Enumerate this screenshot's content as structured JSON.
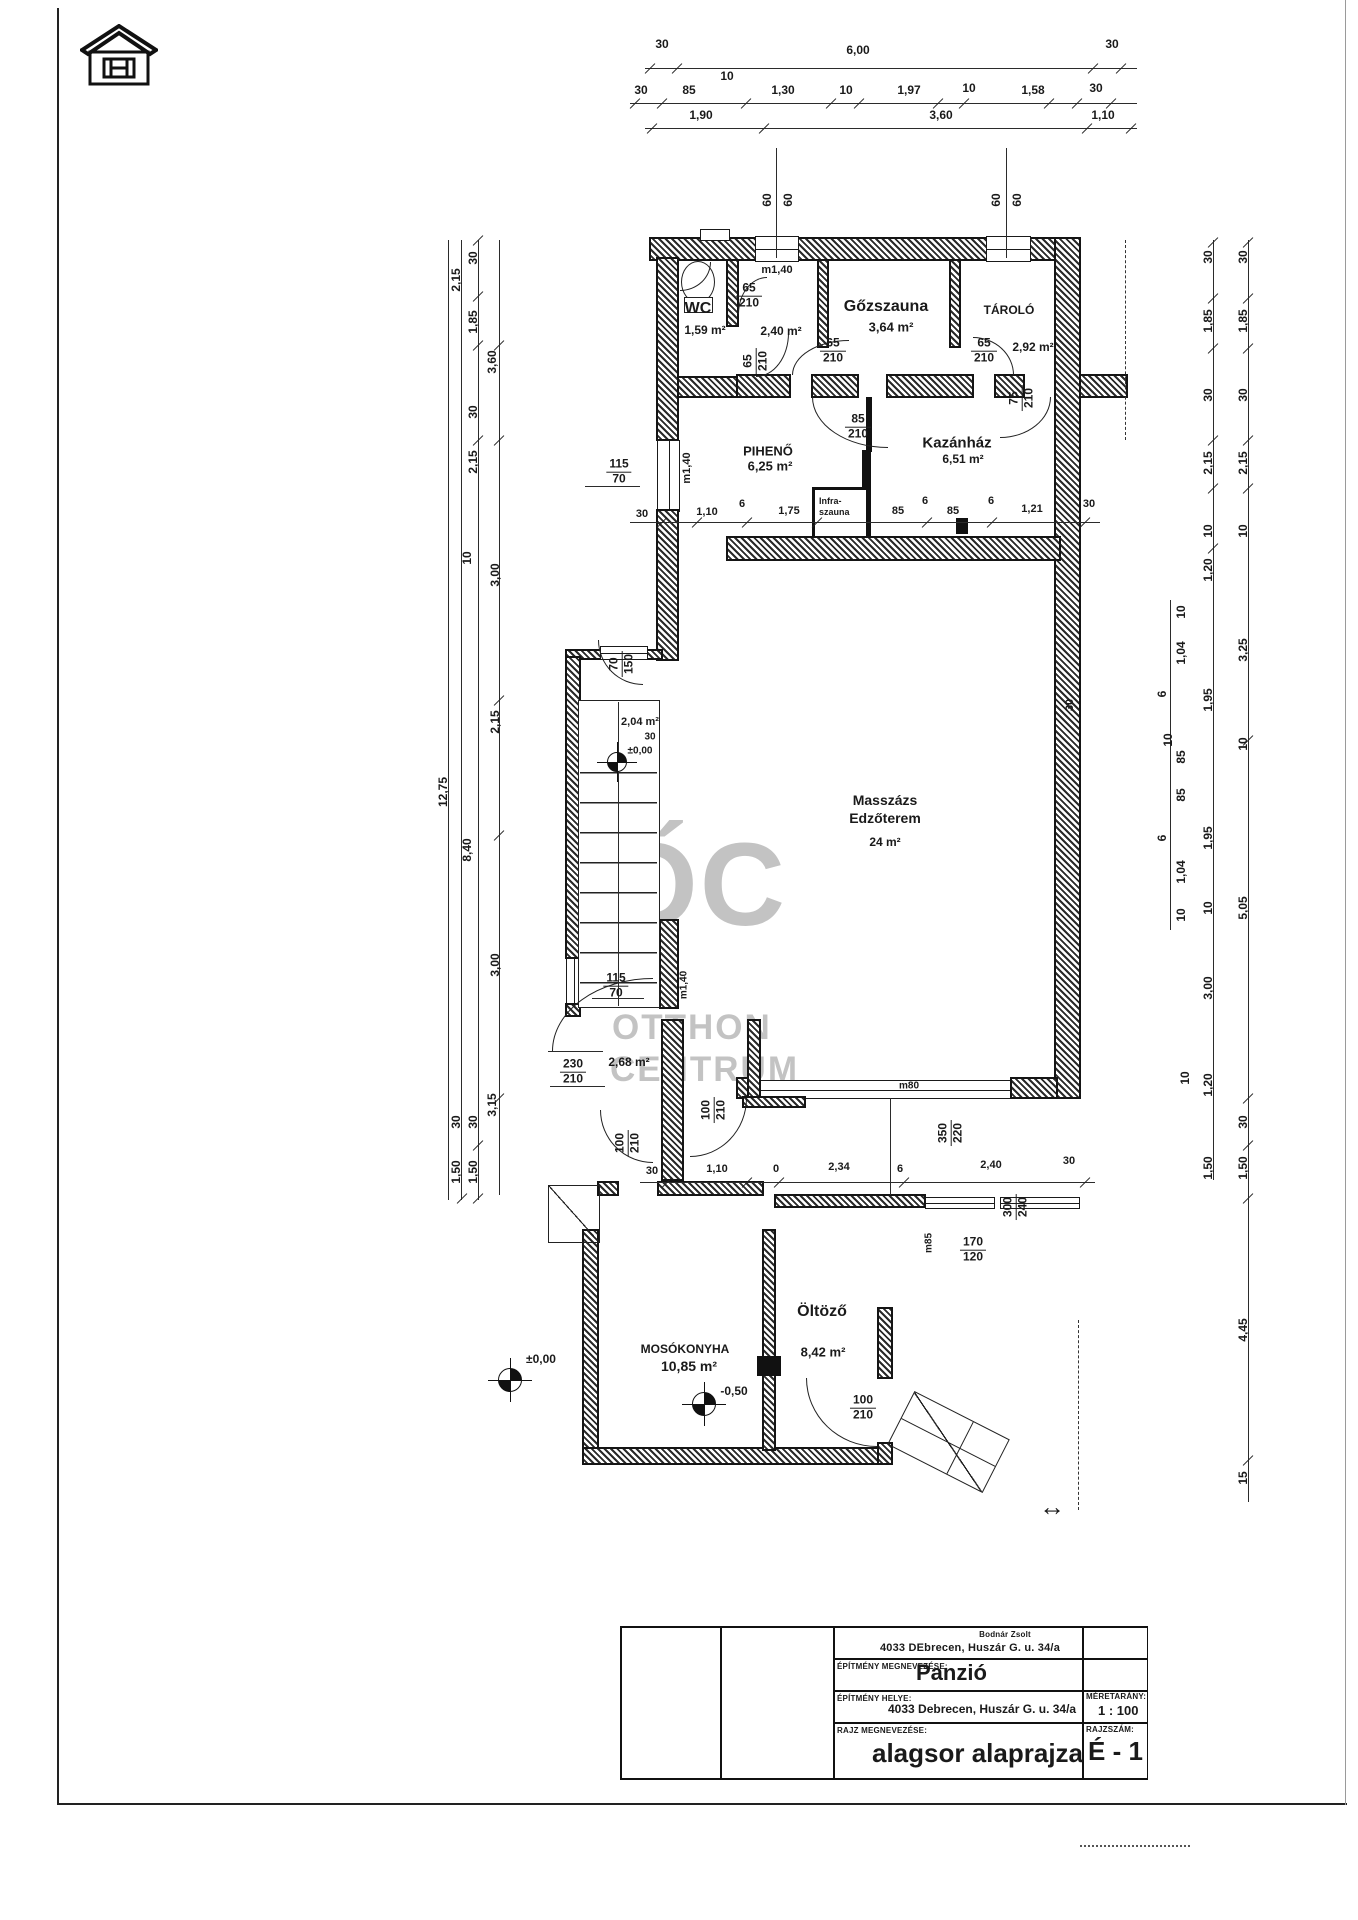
{
  "title_block": {
    "owner_name": "Bodnár Zsolt",
    "owner_address": "4033 DEbrecen, Huszár G. u. 34/a",
    "building_label": "ÉPÍTMÉNY MEGNEVEZÉSE:",
    "building_value": "Panzió",
    "site_label": "ÉPÍTMÉNY HELYE:",
    "site_value": "4033 Debrecen, Huszár G. u. 34/a",
    "scale_label": "MÉRETARÁNY:",
    "scale_value": "1 : 100",
    "drawing_label": "RAJZ MEGNEVEZÉSE:",
    "drawing_value": "alagsor alaprajza",
    "number_label": "RAJZSZÁM:",
    "number_value": "É - 1"
  },
  "watermark": {
    "monogram": "ŐC",
    "line1": "OTTHON",
    "line2": "CENTRUM"
  },
  "infra_box": {
    "line1": "Infra-",
    "line2": "szauna"
  },
  "labels": [
    {
      "t": "30",
      "x": 662,
      "y": 44
    },
    {
      "t": "6,00",
      "x": 858,
      "y": 50
    },
    {
      "t": "30",
      "x": 1112,
      "y": 44
    },
    {
      "t": "10",
      "x": 727,
      "y": 76
    },
    {
      "t": "30",
      "x": 641,
      "y": 90
    },
    {
      "t": "85",
      "x": 689,
      "y": 90
    },
    {
      "t": "1,30",
      "x": 783,
      "y": 90
    },
    {
      "t": "10",
      "x": 846,
      "y": 90
    },
    {
      "t": "1,97",
      "x": 909,
      "y": 90
    },
    {
      "t": "10",
      "x": 969,
      "y": 88
    },
    {
      "t": "1,58",
      "x": 1033,
      "y": 90
    },
    {
      "t": "30",
      "x": 1096,
      "y": 88
    },
    {
      "t": "1,90",
      "x": 701,
      "y": 115
    },
    {
      "t": "3,60",
      "x": 941,
      "y": 115
    },
    {
      "t": "1,10",
      "x": 1103,
      "y": 115
    },
    {
      "t": "60",
      "x": 767,
      "y": 200,
      "r": -90
    },
    {
      "t": "60",
      "x": 788,
      "y": 200,
      "r": -90
    },
    {
      "t": "60",
      "x": 996,
      "y": 200,
      "r": -90
    },
    {
      "t": "60",
      "x": 1017,
      "y": 200,
      "r": -90
    },
    {
      "t": "2,15",
      "x": 456,
      "y": 280,
      "r": -90
    },
    {
      "t": "30",
      "x": 473,
      "y": 258,
      "r": -90
    },
    {
      "t": "1,85",
      "x": 473,
      "y": 322,
      "r": -90
    },
    {
      "t": "3,60",
      "x": 492,
      "y": 362,
      "r": -90
    },
    {
      "t": "30",
      "x": 473,
      "y": 412,
      "r": -90
    },
    {
      "t": "2,15",
      "x": 473,
      "y": 462,
      "r": -90
    },
    {
      "t": "10",
      "x": 467,
      "y": 558,
      "r": -90
    },
    {
      "t": "3,00",
      "x": 495,
      "y": 575,
      "r": -90
    },
    {
      "t": "2,15",
      "x": 495,
      "y": 722,
      "r": -90
    },
    {
      "t": "12,75",
      "x": 443,
      "y": 792,
      "r": -90
    },
    {
      "t": "8,40",
      "x": 467,
      "y": 850,
      "r": -90
    },
    {
      "t": "3,00",
      "x": 495,
      "y": 965,
      "r": -90
    },
    {
      "t": "3,15",
      "x": 492,
      "y": 1105,
      "r": -90
    },
    {
      "t": "30",
      "x": 473,
      "y": 1122,
      "r": -90
    },
    {
      "t": "1,50",
      "x": 473,
      "y": 1172,
      "r": -90
    },
    {
      "t": "30",
      "x": 456,
      "y": 1122,
      "r": -90
    },
    {
      "t": "1,50",
      "x": 456,
      "y": 1172,
      "r": -90
    },
    {
      "t": "30",
      "x": 1208,
      "y": 257,
      "r": -90
    },
    {
      "t": "30",
      "x": 1243,
      "y": 257,
      "r": -90
    },
    {
      "t": "1,85",
      "x": 1208,
      "y": 321,
      "r": -90
    },
    {
      "t": "1,85",
      "x": 1243,
      "y": 321,
      "r": -90
    },
    {
      "t": "30",
      "x": 1208,
      "y": 395,
      "r": -90
    },
    {
      "t": "30",
      "x": 1243,
      "y": 395,
      "r": -90
    },
    {
      "t": "2,15",
      "x": 1208,
      "y": 463,
      "r": -90
    },
    {
      "t": "2,15",
      "x": 1243,
      "y": 463,
      "r": -90
    },
    {
      "t": "10",
      "x": 1208,
      "y": 531,
      "r": -90
    },
    {
      "t": "10",
      "x": 1243,
      "y": 531,
      "r": -90
    },
    {
      "t": "1,20",
      "x": 1208,
      "y": 570,
      "r": -90
    },
    {
      "t": "10",
      "x": 1181,
      "y": 612,
      "r": -90
    },
    {
      "t": "1,04",
      "x": 1181,
      "y": 653,
      "r": -90
    },
    {
      "t": "6",
      "x": 1162,
      "y": 694,
      "r": -90
    },
    {
      "t": "3,25",
      "x": 1243,
      "y": 650,
      "r": -90
    },
    {
      "t": "1,95",
      "x": 1208,
      "y": 700,
      "r": -90
    },
    {
      "t": "10",
      "x": 1168,
      "y": 740,
      "r": -90
    },
    {
      "t": "85",
      "x": 1181,
      "y": 757,
      "r": -90
    },
    {
      "t": "10",
      "x": 1243,
      "y": 744,
      "r": -90
    },
    {
      "t": "85",
      "x": 1181,
      "y": 795,
      "r": -90
    },
    {
      "t": "6",
      "x": 1162,
      "y": 838,
      "r": -90
    },
    {
      "t": "1,04",
      "x": 1181,
      "y": 872,
      "r": -90
    },
    {
      "t": "1,95",
      "x": 1208,
      "y": 838,
      "r": -90
    },
    {
      "t": "10",
      "x": 1181,
      "y": 915,
      "r": -90
    },
    {
      "t": "10",
      "x": 1208,
      "y": 908,
      "r": -90
    },
    {
      "t": "5,05",
      "x": 1243,
      "y": 908,
      "r": -90
    },
    {
      "t": "3,00",
      "x": 1208,
      "y": 988,
      "r": -90
    },
    {
      "t": "10",
      "x": 1185,
      "y": 1078,
      "r": -90
    },
    {
      "t": "1,20",
      "x": 1208,
      "y": 1085,
      "r": -90
    },
    {
      "t": "30",
      "x": 1243,
      "y": 1122,
      "r": -90
    },
    {
      "t": "1,50",
      "x": 1208,
      "y": 1168,
      "r": -90
    },
    {
      "t": "1,50",
      "x": 1243,
      "y": 1168,
      "r": -90
    },
    {
      "t": "4,45",
      "x": 1243,
      "y": 1330,
      "r": -90
    },
    {
      "t": "15",
      "x": 1243,
      "y": 1478,
      "r": -90
    },
    {
      "t": "WC",
      "x": 698,
      "y": 309,
      "s": 16,
      "n": "room-name-wc"
    },
    {
      "t": "1,59 m²",
      "x": 705,
      "y": 330,
      "s": 12,
      "n": "room-area-wc"
    },
    {
      "t": "m1,40",
      "x": 777,
      "y": 270,
      "s": 11
    },
    {
      "t": "2,40 m²",
      "x": 781,
      "y": 331,
      "s": 12,
      "n": "room-area-corridor"
    },
    {
      "t": "Gőzszauna",
      "x": 886,
      "y": 307,
      "s": 16,
      "n": "room-name-gozszauna"
    },
    {
      "t": "3,64 m²",
      "x": 891,
      "y": 327,
      "s": 13,
      "n": "room-area-gozszauna"
    },
    {
      "t": "TÁROLÓ",
      "x": 1009,
      "y": 310,
      "s": 12,
      "n": "room-name-tarolo"
    },
    {
      "t": "2,92 m²",
      "x": 1033,
      "y": 347,
      "s": 12,
      "n": "room-area-tarolo"
    },
    {
      "t": "PIHENŐ",
      "x": 768,
      "y": 451,
      "s": 13,
      "n": "room-name-piheno"
    },
    {
      "t": "6,25 m²",
      "x": 770,
      "y": 466,
      "s": 13,
      "n": "room-area-piheno"
    },
    {
      "t": "Kazánház",
      "x": 957,
      "y": 443,
      "s": 15,
      "n": "room-name-kazanhaz"
    },
    {
      "t": "6,51 m²",
      "x": 963,
      "y": 459,
      "s": 12,
      "n": "room-area-kazanhaz"
    },
    {
      "t": "m1,40",
      "x": 687,
      "y": 468,
      "r": -90,
      "s": 11
    },
    {
      "t": "30",
      "x": 642,
      "y": 514,
      "s": 11
    },
    {
      "t": "1,10",
      "x": 707,
      "y": 512,
      "s": 11
    },
    {
      "t": "6",
      "x": 742,
      "y": 504,
      "s": 11
    },
    {
      "t": "1,75",
      "x": 789,
      "y": 511,
      "s": 11
    },
    {
      "t": "85",
      "x": 898,
      "y": 511,
      "s": 11
    },
    {
      "t": "6",
      "x": 925,
      "y": 501,
      "s": 11
    },
    {
      "t": "85",
      "x": 953,
      "y": 511,
      "s": 11
    },
    {
      "t": "6",
      "x": 991,
      "y": 501,
      "s": 11
    },
    {
      "t": "1,21",
      "x": 1032,
      "y": 509,
      "s": 11
    },
    {
      "t": "30",
      "x": 1089,
      "y": 504,
      "s": 11
    },
    {
      "t": "Masszázs",
      "x": 885,
      "y": 800,
      "s": 14,
      "n": "room-name-masszazs"
    },
    {
      "t": "Edzőterem",
      "x": 885,
      "y": 818,
      "s": 14
    },
    {
      "t": "24 m²",
      "x": 885,
      "y": 842,
      "s": 12,
      "n": "room-area-masszazs"
    },
    {
      "t": "30",
      "x": 1070,
      "y": 705,
      "r": -90,
      "s": 11
    },
    {
      "t": "2,04 m²",
      "x": 640,
      "y": 722,
      "s": 11,
      "n": "room-area-stair"
    },
    {
      "t": "30",
      "x": 650,
      "y": 737,
      "s": 10
    },
    {
      "t": "±0,00",
      "x": 640,
      "y": 751,
      "s": 10,
      "n": "level-mark"
    },
    {
      "t": "m1,40",
      "x": 684,
      "y": 985,
      "r": -90,
      "s": 10
    },
    {
      "t": "2,68 m²",
      "x": 629,
      "y": 1062,
      "s": 12,
      "n": "room-area-lobby"
    },
    {
      "t": "m80",
      "x": 909,
      "y": 1086,
      "s": 10
    },
    {
      "t": "30",
      "x": 652,
      "y": 1171,
      "s": 11
    },
    {
      "t": "1,10",
      "x": 717,
      "y": 1169,
      "s": 11
    },
    {
      "t": "0",
      "x": 776,
      "y": 1169,
      "s": 11
    },
    {
      "t": "2,34",
      "x": 839,
      "y": 1167,
      "s": 11
    },
    {
      "t": "6",
      "x": 900,
      "y": 1169,
      "s": 11
    },
    {
      "t": "2,40",
      "x": 991,
      "y": 1165,
      "s": 11
    },
    {
      "t": "30",
      "x": 1069,
      "y": 1161,
      "s": 11
    },
    {
      "t": "m85",
      "x": 929,
      "y": 1243,
      "r": -90,
      "s": 10
    },
    {
      "t": "Öltöző",
      "x": 822,
      "y": 1312,
      "s": 16,
      "n": "room-name-oltozo"
    },
    {
      "t": "8,42 m²",
      "x": 823,
      "y": 1352,
      "s": 13,
      "n": "room-area-oltozo"
    },
    {
      "t": "MOSÓKONYHA",
      "x": 685,
      "y": 1349,
      "s": 12,
      "n": "room-name-mosokonyha"
    },
    {
      "t": "10,85 m²",
      "x": 689,
      "y": 1366,
      "s": 14,
      "n": "room-area-mosokonyha"
    },
    {
      "t": "-0,50",
      "x": 734,
      "y": 1391,
      "s": 12,
      "n": "level-mark"
    },
    {
      "t": "±0,00",
      "x": 541,
      "y": 1359,
      "s": 12,
      "n": "level-mark"
    },
    {
      "t": "↔",
      "x": 1052,
      "y": 1507,
      "s": 26
    }
  ],
  "fractions": [
    {
      "num": "65",
      "den": "210",
      "x": 749,
      "y": 296
    },
    {
      "num": "65",
      "den": "210",
      "x": 833,
      "y": 351
    },
    {
      "num": "65",
      "den": "210",
      "x": 984,
      "y": 351
    },
    {
      "num": "75",
      "den": "210",
      "x": 1022,
      "y": 398,
      "r": -90
    },
    {
      "num": "65",
      "den": "210",
      "x": 756,
      "y": 361,
      "r": -90
    },
    {
      "num": "85",
      "den": "210",
      "x": 858,
      "y": 427
    },
    {
      "num": "115",
      "den": "70",
      "x": 619,
      "y": 472
    },
    {
      "num": "70",
      "den": "150",
      "x": 622,
      "y": 664,
      "r": -90
    },
    {
      "num": "115",
      "den": "70",
      "x": 616,
      "y": 986
    },
    {
      "num": "230",
      "den": "210",
      "x": 573,
      "y": 1072
    },
    {
      "num": "100",
      "den": "210",
      "x": 628,
      "y": 1143,
      "r": -90
    },
    {
      "num": "100",
      "den": "210",
      "x": 714,
      "y": 1110,
      "r": -90
    },
    {
      "num": "350",
      "den": "220",
      "x": 951,
      "y": 1133,
      "r": -90
    },
    {
      "num": "300",
      "den": "240",
      "x": 1016,
      "y": 1207,
      "r": -90
    },
    {
      "num": "170",
      "den": "120",
      "x": 973,
      "y": 1250
    },
    {
      "num": "100",
      "den": "210",
      "x": 863,
      "y": 1408
    }
  ]
}
